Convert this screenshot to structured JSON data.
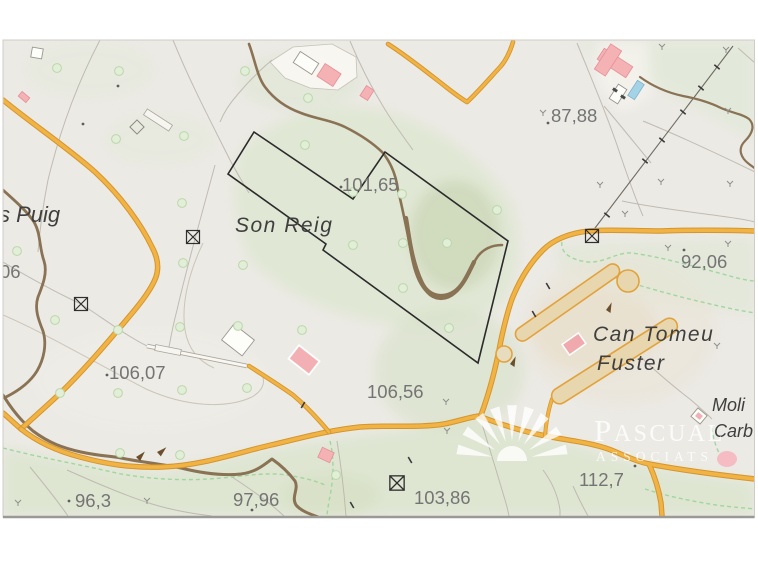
{
  "map": {
    "place_labels": {
      "puig": "s Puig",
      "son_reig": "Son Reig",
      "can_tomeu_line1": "Can Tomeu",
      "can_tomeu_line2": "Fuster",
      "moli_line1": "Moli",
      "moli_line2": "Carb"
    },
    "elevation_labels": {
      "e87": "87,88",
      "e101": "101,65",
      "e92": "92,06",
      "e106a": "106,07",
      "e106b": "106,56",
      "e96": "96,3",
      "e97": "97,96",
      "e103": "103,86",
      "e112": "112,7",
      "e06": "06"
    },
    "colors": {
      "road": "#f2b345",
      "road_casing": "#d4952e",
      "stream_brown": "#8a7254",
      "boundary_black": "#2b2b2b",
      "green_dash": "#9ad497",
      "building_pink": "#f4b2b5",
      "pool_blue": "#a4d3e8",
      "place_label_gray": "#3f3f3f",
      "elevation_gray": "#747474",
      "vegetation_green": "#dce5cf"
    }
  },
  "watermark": {
    "company": "Pascual Associats",
    "line1_initial": "P",
    "line1_rest": "ASCUAL",
    "line2": "ASSOCIATS"
  }
}
